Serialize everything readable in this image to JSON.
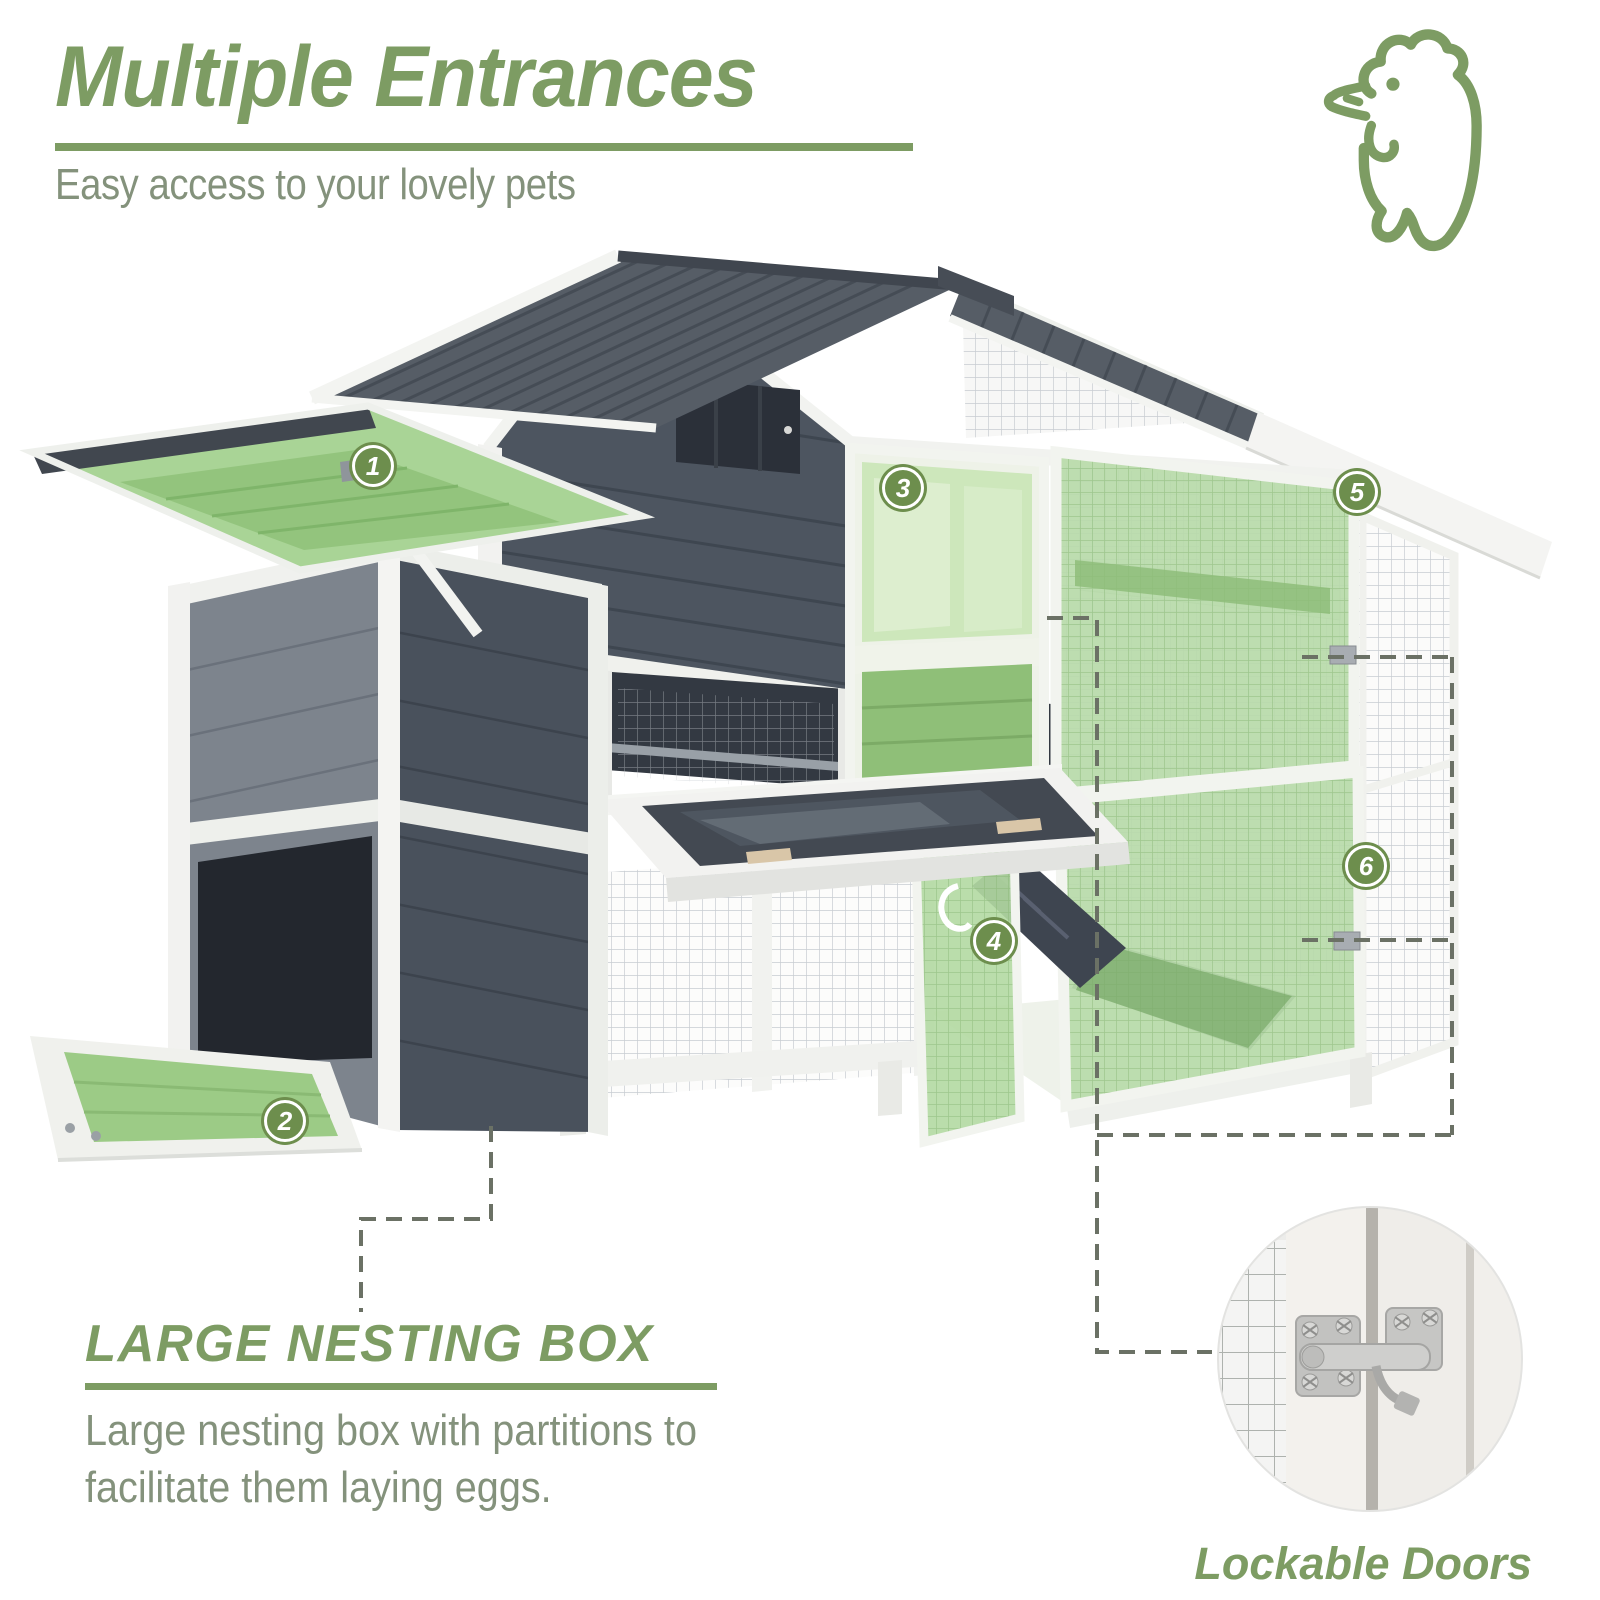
{
  "header": {
    "title": "Multiple Entrances",
    "subtitle": "Easy access to your lovely pets"
  },
  "hero_icon": "rooster-outline-icon",
  "callouts": [
    {
      "n": "1",
      "feature": "openable nesting box lid"
    },
    {
      "n": "2",
      "feature": "flip-down nesting box tray"
    },
    {
      "n": "3",
      "feature": "upper coop door"
    },
    {
      "n": "4",
      "feature": "lower run door with ramp"
    },
    {
      "n": "5",
      "feature": "large upper run door"
    },
    {
      "n": "6",
      "feature": "large lower run door"
    }
  ],
  "feature": {
    "heading": "LARGE NESTING BOX",
    "line1": "Large nesting box with partitions to",
    "line2": "facilitate them laying eggs."
  },
  "inset": {
    "caption": "Lockable Doors",
    "image": "latch-closeup-photo"
  },
  "colors": {
    "accent": "#7d9c63",
    "text": "#84927c",
    "badge": "#6d8e4d",
    "dash": "#6b7165",
    "highlight": "#b5daa6",
    "roof": "#565d66",
    "wall_dark": "#4d5560",
    "wall_light": "#7d848d",
    "frame_white": "#f2f3f0"
  }
}
